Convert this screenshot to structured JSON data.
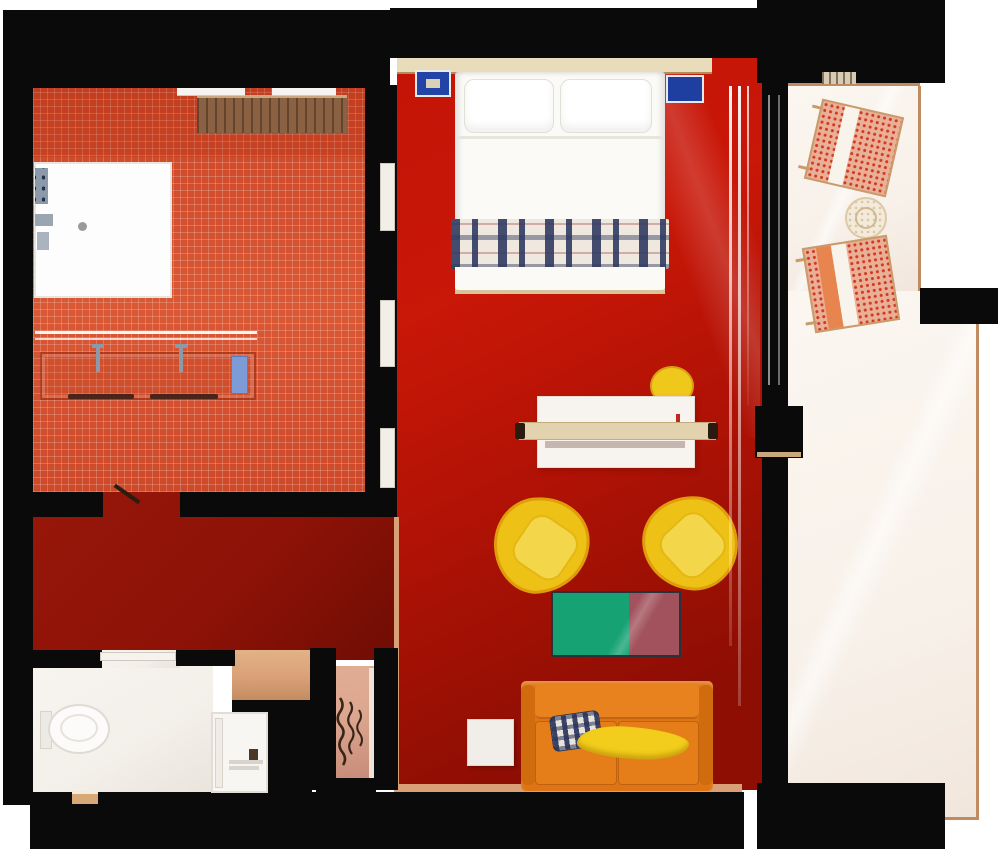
{
  "meta": {
    "app": "floor-plan-render",
    "description": "Top-down 3D rendered floor plan of a hotel suite",
    "canvas": {
      "width": 1000,
      "height": 849
    }
  },
  "colors": {
    "wall": "#0b0a0a",
    "tileFloor": "#d7512f",
    "hallFloor": "#8e1207",
    "bedroomFloorA": "#c91708",
    "bedroomFloorB": "#8e0e04",
    "balconyFloor": "#f8f1ea",
    "balconyEdge": "#c08b60",
    "wcFloor": "#f3efe9",
    "entryFloor": "#d9a077",
    "closetFloorA": "#dca68f",
    "closetFloorB": "#c68b78",
    "bedWhite": "#fbfaf7",
    "headboard": "#e9dcba",
    "nightstandBlue": "#2344a6",
    "nightstandInner": "#1e3fa0",
    "plaidBase": "#efe8df",
    "deskWhite": "#f7f4f0",
    "plankWood": "#e2d2ae",
    "plankCap": "#2a1a10",
    "stoolYellow": "#f0c81c",
    "chairYellow": "#eec117",
    "chairYellowInner": "#f4d64a",
    "chairOutline": "#e09c0b",
    "tableGreen": "#17a273",
    "tableMaroon": "#a2525c",
    "sofaOrange": "#de7413",
    "sofaCushion": "#e8821f",
    "throwYellow": "#f2cd1b",
    "sideTable": "#f1eeea",
    "shelfWood": "#8a6142",
    "woodTrim": "#c9a87c",
    "showerTray": "#fdfdfd",
    "fixtureGray": "#8c99a8",
    "towelBlue": "#7d9bd6",
    "towelBar": "#4a2418",
    "patioChairBase": "#e9af97",
    "patioChairDot": "#d03a20",
    "patioFrame": "#c99a6a",
    "patioTable": "#f3ead9",
    "toiletWhite": "#fcfbf9",
    "doorPanel": "#f2efe9",
    "hanger": "#38251a"
  },
  "rooms": [
    {
      "id": "wet-room",
      "label": "Wet room with walk-in shower, double vanity and wardrobe shelf"
    },
    {
      "id": "hallway",
      "label": "Hallway"
    },
    {
      "id": "bedroom-living",
      "label": "Bedroom and living area"
    },
    {
      "id": "balcony",
      "label": "Balcony terrace"
    },
    {
      "id": "wc",
      "label": "WC with shower stall"
    },
    {
      "id": "entry",
      "label": "Entry alcove"
    },
    {
      "id": "closet",
      "label": "Closet with hangers"
    }
  ],
  "furniture": [
    {
      "id": "walk-in-shower-tray",
      "label": "Walk-in shower tray with drain"
    },
    {
      "id": "double-vanity",
      "label": "Double sink vanity counter"
    },
    {
      "id": "wardrobe-shelf",
      "label": "Wooden wardrobe shelf"
    },
    {
      "id": "double-bed",
      "label": "Double bed with plaid runner"
    },
    {
      "id": "nightstand-left",
      "label": "Blue nightstand"
    },
    {
      "id": "nightstand-right",
      "label": "Blue nightstand"
    },
    {
      "id": "desk",
      "label": "Desk with wooden ledge"
    },
    {
      "id": "desk-stool",
      "label": "Yellow stool"
    },
    {
      "id": "armchair-left",
      "label": "Yellow lounge armchair"
    },
    {
      "id": "armchair-right",
      "label": "Yellow lounge armchair"
    },
    {
      "id": "coffee-table",
      "label": "Two-tone green and maroon table"
    },
    {
      "id": "sofa",
      "label": "Orange sofa with cushions"
    },
    {
      "id": "side-table",
      "label": "White side table"
    },
    {
      "id": "patio-chair-top",
      "label": "Woven patio chair"
    },
    {
      "id": "patio-chair-bottom",
      "label": "Woven patio chair"
    },
    {
      "id": "patio-table",
      "label": "Round woven patio table"
    },
    {
      "id": "toilet",
      "label": "Toilet"
    },
    {
      "id": "shower-stall",
      "label": "Shower stall"
    },
    {
      "id": "coat-hangers",
      "label": "Clothes hangers"
    }
  ]
}
